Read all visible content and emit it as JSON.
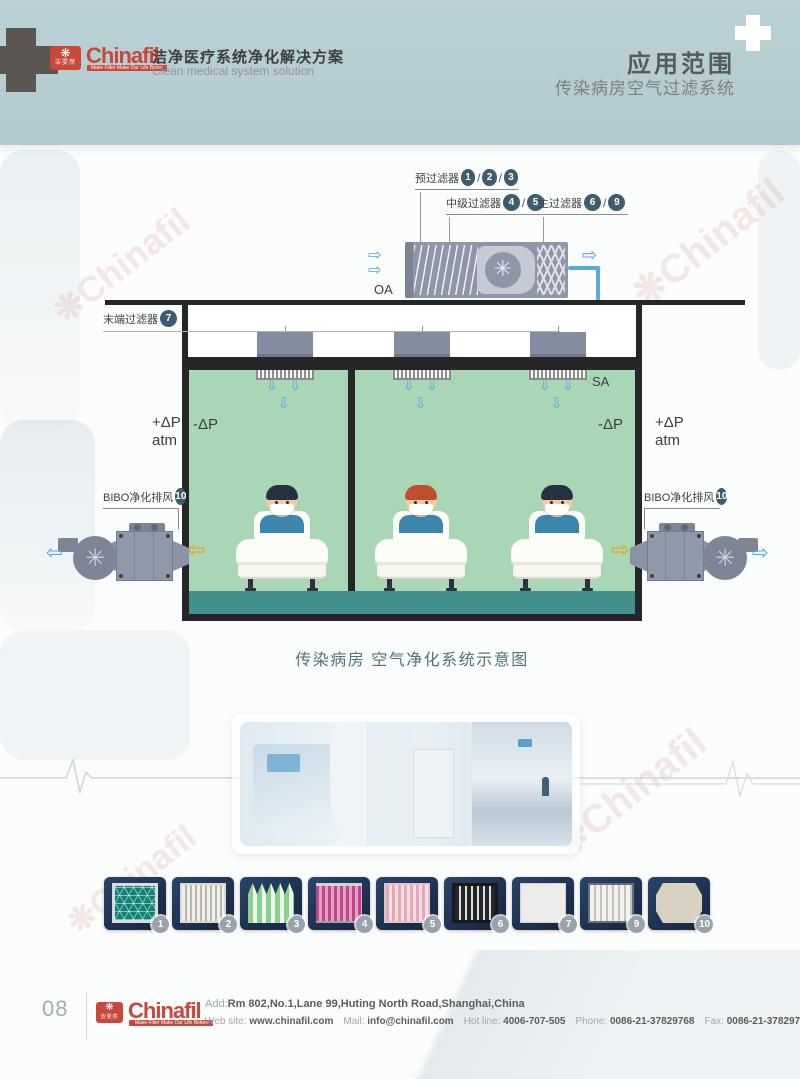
{
  "header": {
    "logo_text": "Chinafil",
    "logo_mark_text": "洁雯然",
    "logo_tagline": "Make Filter Make Our Life Better",
    "title_cn": "洁净医疗系统净化解决方案",
    "title_en": "Clean medical system solution",
    "page_title": "应用范围",
    "page_subtitle": "传染病房空气过滤系统"
  },
  "glyphs": {
    "arrow_right": "⇨",
    "arrow_left": "⇦",
    "arrow_down": "⇩",
    "supply_arrows": "⇩ ⇩ ⇩",
    "fan": "✳",
    "flower": "❋"
  },
  "diagram": {
    "sep": "/",
    "labels": {
      "prefilter": {
        "text": "预过滤器",
        "nums": [
          "1",
          "2",
          "3"
        ]
      },
      "midfilter": {
        "text": "中级过滤器",
        "nums": [
          "4",
          "5"
        ]
      },
      "mainfilter": {
        "text": "主过滤器",
        "nums": [
          "6",
          "9"
        ]
      },
      "terminal": {
        "text": "末端过滤器",
        "num": "7"
      },
      "bibo_left": {
        "text": "BIBO净化排风",
        "num": "10"
      },
      "bibo_right": {
        "text": "BIBO净化排风",
        "num": "10"
      }
    },
    "flow": {
      "oa": "OA",
      "sa": "SA"
    },
    "pressure": {
      "plus": "+ΔP",
      "atm": "atm",
      "minus": "-ΔP"
    },
    "caption": "传染病房 空气净化系统示意图",
    "colors": {
      "duct_blue": "#58aae3",
      "room_green": "#a9d6b5",
      "floor_teal": "#43908d",
      "unit_gray": "#8e96a8",
      "accent_orange": "#f39c12",
      "wall_black": "#262626",
      "number_badge": "#3d5c6e"
    }
  },
  "watermark": {
    "text": "Chinafil",
    "color": "#c0392b"
  },
  "thumbnails": [
    {
      "number": "1",
      "name": "green-mesh-pre-filter"
    },
    {
      "number": "2",
      "name": "pleated-panel-filter"
    },
    {
      "number": "3",
      "name": "green-pocket-filter"
    },
    {
      "number": "4",
      "name": "pink-pocket-filter"
    },
    {
      "number": "5",
      "name": "pink-box-filter"
    },
    {
      "number": "6",
      "name": "v-bank-hepa-filter"
    },
    {
      "number": "7",
      "name": "flat-panel-hepa-filter"
    },
    {
      "number": "9",
      "name": "pleated-hepa-filter"
    },
    {
      "number": "10",
      "name": "bibo-housing-unit"
    }
  ],
  "footer": {
    "page_number": "08",
    "logo_text": "Chinafil",
    "logo_mark_text": "洁雯然",
    "logo_tagline": "Make Filter Make Our Life Better",
    "address_label": "Add:",
    "address_value": "Rm 802,No.1,Lane 99,Huting North Road,Shanghai,China",
    "contacts": [
      {
        "label": "Web site:",
        "value": "www.chinafil.com"
      },
      {
        "label": "Mail:",
        "value": "info@chinafil.com"
      },
      {
        "label": "Hot line:",
        "value": "4006-707-505"
      },
      {
        "label": "Phone:",
        "value": "0086-21-37829768"
      },
      {
        "label": "Fax:",
        "value": "0086-21-37829728"
      }
    ]
  }
}
